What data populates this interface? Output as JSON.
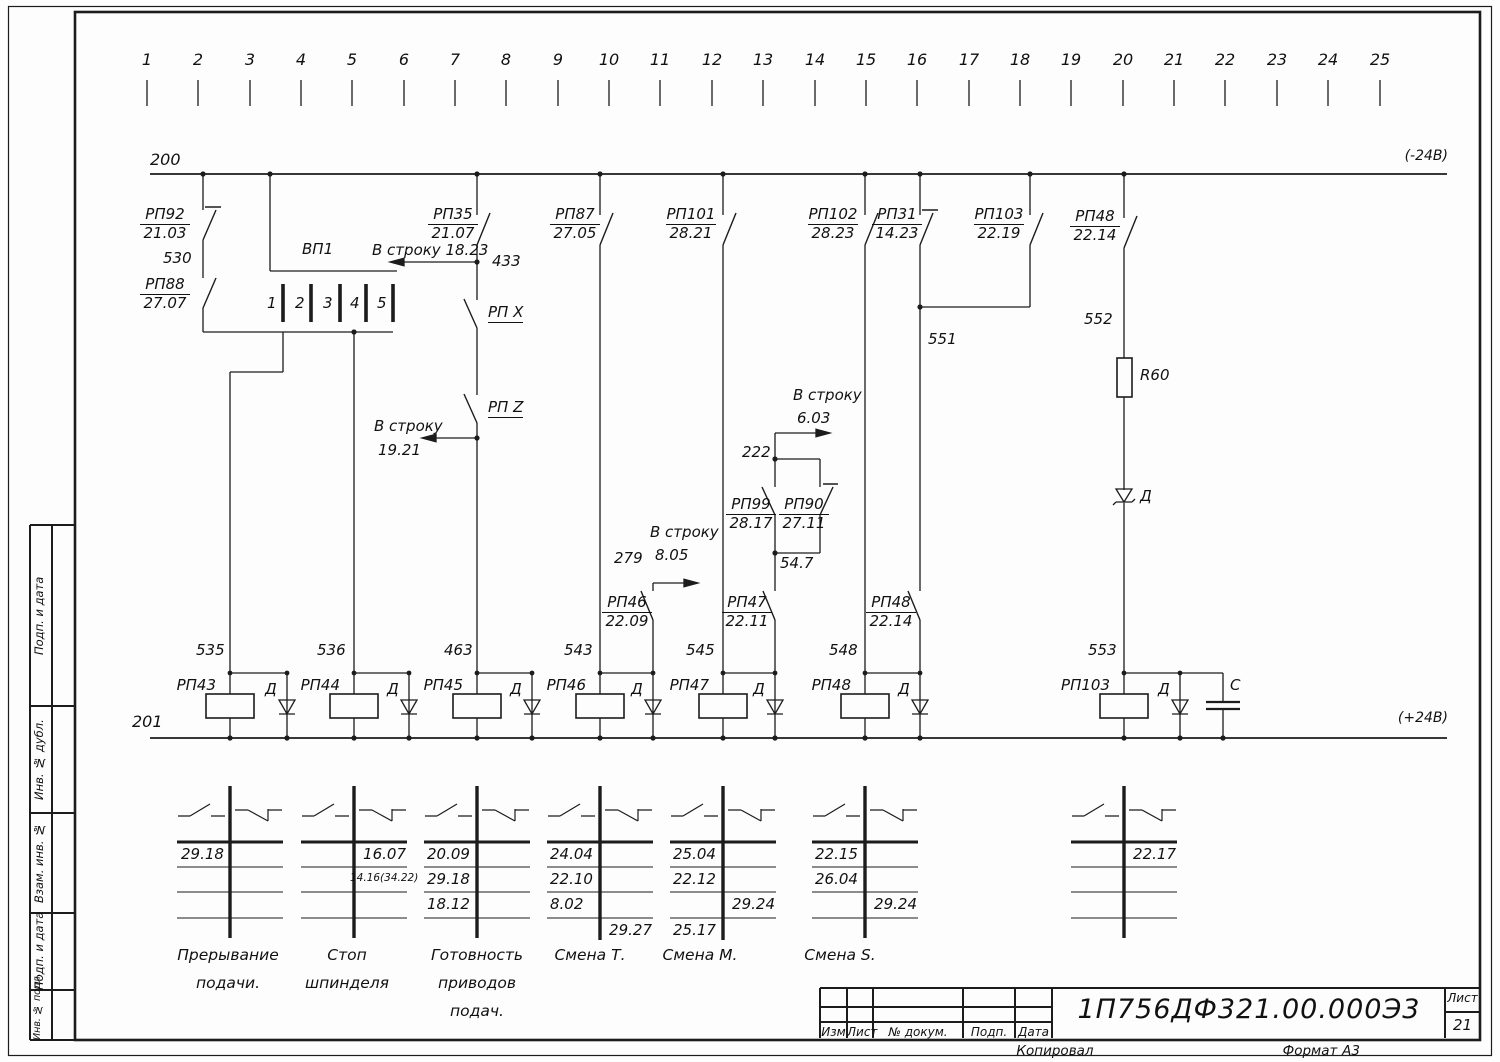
{
  "ruler": [
    "1",
    "2",
    "3",
    "4",
    "5",
    "6",
    "7",
    "8",
    "9",
    "10",
    "11",
    "12",
    "13",
    "14",
    "15",
    "16",
    "17",
    "18",
    "19",
    "20",
    "21",
    "22",
    "23",
    "24",
    "25"
  ],
  "buses": {
    "top_number": "200",
    "top_voltage": "(-24В)",
    "bottom_number": "201",
    "bottom_voltage": "(+24В)"
  },
  "relay_contacts": {
    "rp92": {
      "name": "РП92",
      "ref": "21.03"
    },
    "rp88": {
      "name": "РП88",
      "ref": "27.07"
    },
    "rp35": {
      "name": "РП35",
      "ref": "21.07"
    },
    "rp87": {
      "name": "РП87",
      "ref": "27.05"
    },
    "rp101": {
      "name": "РП101",
      "ref": "28.21"
    },
    "rp102": {
      "name": "РП102",
      "ref": "28.23"
    },
    "rp31": {
      "name": "РП31",
      "ref": "14.23"
    },
    "rp103": {
      "name": "РП103",
      "ref": "22.19"
    },
    "rp48_top": {
      "name": "РП48",
      "ref": "22.14"
    },
    "rp99": {
      "name": "РП99",
      "ref": "28.17"
    },
    "rp90": {
      "name": "РП90",
      "ref": "27.11"
    },
    "rp46": {
      "name": "РП46",
      "ref": "22.09"
    },
    "rp47": {
      "name": "РП47",
      "ref": "22.11"
    },
    "rp48_bot": {
      "name": "РП48",
      "ref": "22.14"
    },
    "rpx": "РП X",
    "rpz": "РП Z"
  },
  "vp1": {
    "label": "ВП1",
    "pins": [
      "1",
      "2",
      "3",
      "4",
      "5"
    ]
  },
  "wire_numbers": {
    "n530": "530",
    "n433": "433",
    "n551": "551",
    "n552": "552",
    "n222": "222",
    "n547": "54.7",
    "n279": "279",
    "n535": "535",
    "n536": "536",
    "n463": "463",
    "n543": "543",
    "n545": "545",
    "n548": "548",
    "n553": "553"
  },
  "row_links": {
    "l1823": {
      "label": "В строку",
      "ref": "18.23"
    },
    "l1921": {
      "label": "В строку",
      "ref": "19.21"
    },
    "l805": {
      "label": "В строку",
      "ref": "8.05"
    },
    "l603": {
      "label": "В строку",
      "ref": "6.03"
    }
  },
  "components": {
    "r60": "R60",
    "zener": "Д",
    "cap": "С"
  },
  "coils": [
    {
      "name": "РП43",
      "diode": "Д"
    },
    {
      "name": "РП44",
      "diode": "Д"
    },
    {
      "name": "РП45",
      "diode": "Д"
    },
    {
      "name": "РП46",
      "diode": "Д"
    },
    {
      "name": "РП47",
      "diode": "Д"
    },
    {
      "name": "РП48",
      "diode": "Д"
    },
    {
      "name": "РП103",
      "diode": "Д"
    }
  ],
  "tables": [
    {
      "rows": [
        [
          "29.18",
          ""
        ],
        [
          "",
          ""
        ],
        [
          "",
          ""
        ],
        [
          "",
          ""
        ]
      ],
      "caption": [
        "Прерывание",
        "подачи."
      ]
    },
    {
      "rows": [
        [
          "",
          "16.07"
        ],
        [
          "",
          "14.16(34.22)"
        ],
        [
          "",
          ""
        ],
        [
          "",
          ""
        ]
      ],
      "caption": [
        "Стоп",
        "шпинделя"
      ]
    },
    {
      "rows": [
        [
          "20.09",
          ""
        ],
        [
          "29.18",
          ""
        ],
        [
          "18.12",
          ""
        ],
        [
          "",
          ""
        ]
      ],
      "caption": [
        "Готовность",
        "приводов",
        "подач."
      ]
    },
    {
      "rows": [
        [
          "24.04",
          ""
        ],
        [
          "22.10",
          ""
        ],
        [
          "8.02",
          ""
        ],
        [
          "",
          "29.27"
        ]
      ],
      "caption": [
        "Смена Т."
      ]
    },
    {
      "rows": [
        [
          "25.04",
          ""
        ],
        [
          "22.12",
          ""
        ],
        [
          "",
          "29.24"
        ],
        [
          "25.17",
          ""
        ]
      ],
      "caption": [
        "Смена М."
      ]
    },
    {
      "rows": [
        [
          "22.15",
          ""
        ],
        [
          "26.04",
          ""
        ],
        [
          "",
          "29.24"
        ],
        [
          "",
          ""
        ]
      ],
      "caption": [
        "Смена S."
      ]
    },
    {
      "rows": [
        [
          "",
          "22.17"
        ],
        [
          "",
          ""
        ],
        [
          "",
          ""
        ],
        [
          "",
          ""
        ]
      ],
      "caption": []
    }
  ],
  "title_block": {
    "izm": "Изм",
    "list": "Лист",
    "docum": "№ докум.",
    "podp": "Подп.",
    "data": "Дата",
    "doc_number": "1П756ДФ321.00.000Э3",
    "sheet_label": "Лист",
    "sheet_number": "21",
    "kopiroval": "Копировал",
    "format_label": "Формат",
    "format_value": "А3"
  },
  "sidebar": [
    "Подп. и дата",
    "Инв. № дубл.",
    "Взам. инв. №",
    "Подп. и дата",
    "Инв. № подл."
  ]
}
